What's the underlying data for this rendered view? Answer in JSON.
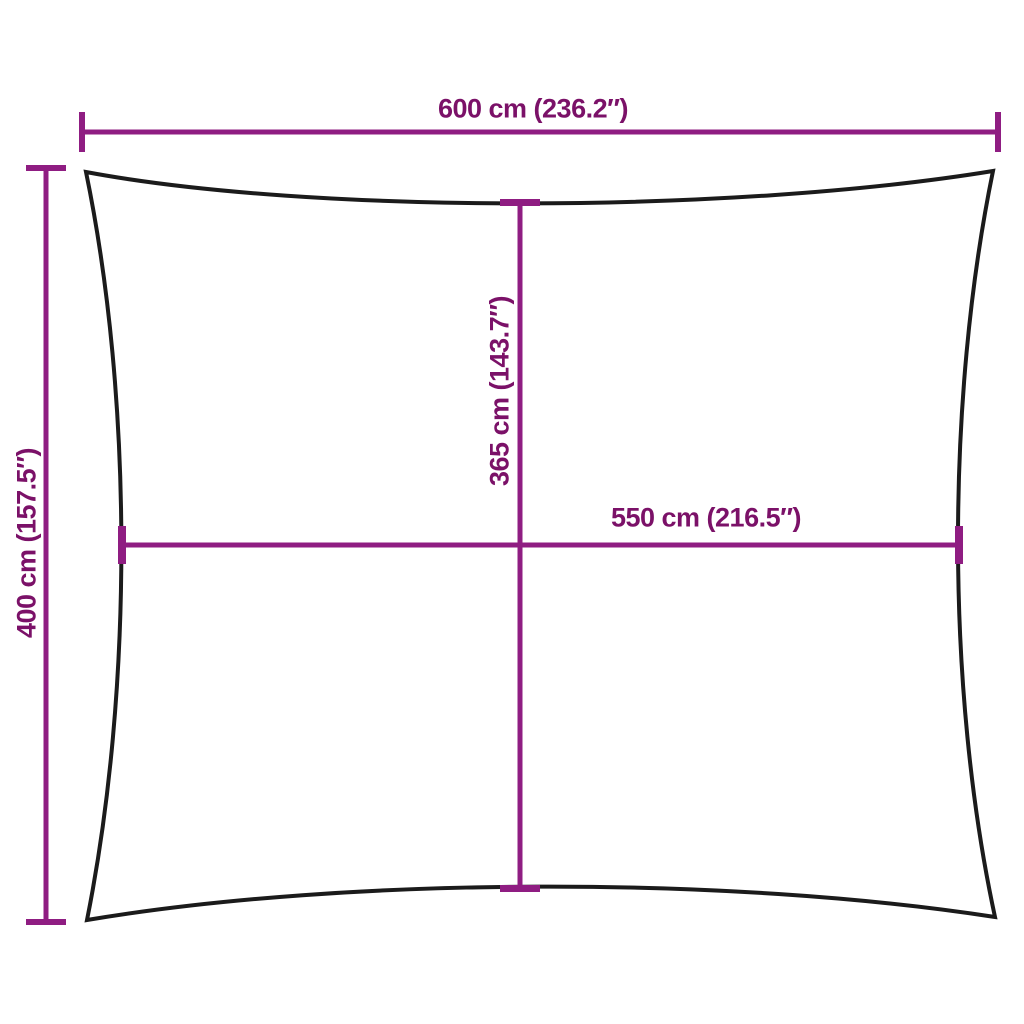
{
  "diagram": {
    "type": "product-dimension-diagram",
    "subject": "rectangular-shade-sail-outline",
    "colors": {
      "background": "#ffffff",
      "sail_outline": "#1b1b1b",
      "dimension_lines": "#8f1d82",
      "label_text": "#7b1168"
    },
    "dimensions": {
      "top_width": {
        "label": "600 cm (236.2″)",
        "cm": "600",
        "inches": "236.2"
      },
      "left_height": {
        "label": "400 cm (157.5″)",
        "cm": "400",
        "inches": "157.5"
      },
      "center_height": {
        "label": "365 cm (143.7″)",
        "cm": "365",
        "inches": "143.7"
      },
      "center_width": {
        "label": "550 cm (216.5″)",
        "cm": "550",
        "inches": "216.5"
      }
    }
  }
}
